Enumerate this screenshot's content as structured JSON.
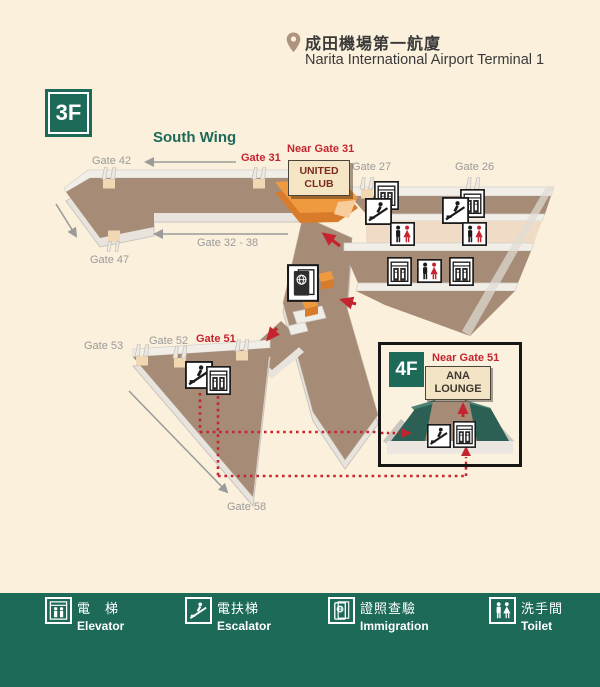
{
  "header": {
    "location_zh": "成田機場第一航廈",
    "location_en": "Narita International Airport Terminal 1"
  },
  "floor": {
    "main": "3F",
    "inset": "4F"
  },
  "map": {
    "wing_label": "South Wing",
    "labels": {
      "gate42": "Gate 42",
      "gate31": "Gate 31",
      "near_gate31": "Near Gate 31",
      "gate27": "Gate 27",
      "gate26": "Gate 26",
      "gate32_38": "Gate 32 - 38",
      "gate47": "Gate 47",
      "gate53": "Gate 53",
      "gate52": "Gate 52",
      "gate51": "Gate 51",
      "gate58": "Gate 58"
    },
    "united_club": "UNITED CLUB",
    "facilities": [
      {
        "area": "near Gate 27",
        "icons": [
          "elevator-icon",
          "escalator-icon",
          "toilet-icon"
        ]
      },
      {
        "area": "near Gate 26",
        "icons": [
          "elevator-icon",
          "escalator-icon",
          "toilet-icon"
        ]
      },
      {
        "area": "concourse lower row",
        "icons": [
          "elevator-icon",
          "toilet-icon",
          "elevator-icon"
        ]
      },
      {
        "area": "central corridor",
        "icons": [
          "immigration-icon"
        ]
      },
      {
        "area": "near Gate 51",
        "icons": [
          "escalator-icon",
          "elevator-icon"
        ]
      }
    ]
  },
  "inset": {
    "near_gate": "Near Gate 51",
    "lounge": "ANA LOUNGE",
    "icons": [
      "escalator-icon",
      "elevator-icon"
    ]
  },
  "legend": {
    "items": [
      {
        "icon": "elevator-icon",
        "zh": "電　梯",
        "en": "Elevator"
      },
      {
        "icon": "escalator-icon",
        "zh": "電扶梯",
        "en": "Escalator"
      },
      {
        "icon": "immigration-icon",
        "zh": "證照查驗",
        "en": "Immigration"
      },
      {
        "icon": "toilet-icon",
        "zh": "洗手間",
        "en": "Toilet"
      }
    ]
  },
  "colors": {
    "teal": "#1E6A59",
    "red": "#C4242F",
    "orange": "#F09A3F",
    "corridor": "#A68C76",
    "background": "#FBF0DC"
  }
}
